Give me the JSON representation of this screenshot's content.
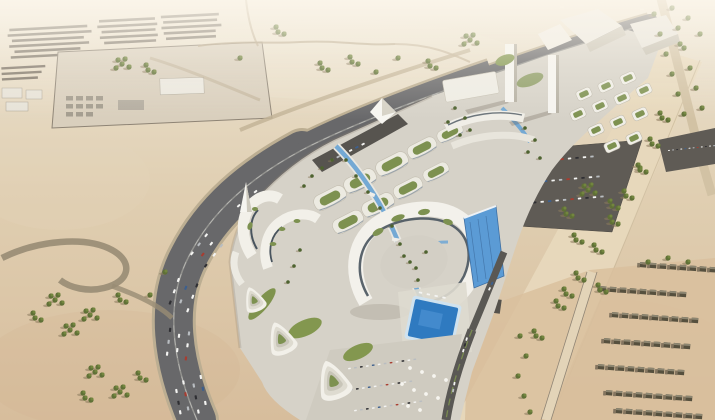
{
  "image": {
    "kind": "aerial-architectural-render",
    "no_visible_text": true,
    "description": "Bird's-eye 3D rendering of a modern desert mixed-use development: white curvilinear buildings with landscaped green roofs arranged on a diagonal podium, wrapped on the west by a curving multi-lane highway full of traffic. Features a sail-shaped spire, a large curved ribbon building with dark glazing and a blue glass slab, a rectangular blue pool with sun deck, stepped triangular terrace buildings, twin white towers with angular event halls and a grid of green-roofed pavilions, asphalt parking lots to the east, barracks-like row compounds to the north-west, scattered desert tree clusters, and a grid village of small flat-roofed houses in the south-east corner."
  },
  "scene": {
    "areas": [
      {
        "name": "northwest-compounds",
        "description": "Rows of dark low-rise barracks blocks and a walled service compound with trees"
      },
      {
        "name": "desert-plain",
        "description": "Open pale sand with faint graded tracks and scattered trees, hazy toward the horizon"
      },
      {
        "name": "west-highway",
        "description": "Curving multi-lane asphalt highway with dense car traffic wrapping the development"
      },
      {
        "name": "uturn-loop",
        "description": "U-turn ramp loop in the south-west desert"
      },
      {
        "name": "central-development",
        "description": "White organic-shaped buildings, palm-lined streets and a blue water canal"
      },
      {
        "name": "gateway-spire",
        "description": "White sail-shaped monument at the south-west gateway"
      },
      {
        "name": "ribbon-building",
        "description": "Large curved building with dark glass band, roof gardens and blue glass slab"
      },
      {
        "name": "pool-deck",
        "description": "Rectangular blue swimming pool with loungers, parasols and parking"
      },
      {
        "name": "terraced-triangles",
        "description": "Stepped triangular terrace buildings with green courtyards"
      },
      {
        "name": "northeast-cluster",
        "description": "Twin white towers, angular halls and grid of green-roofed pavilions"
      },
      {
        "name": "east-parking",
        "description": "Asphalt parking lots filled with cars along the eastern boulevard"
      },
      {
        "name": "southeast-village",
        "description": "Grid rows of small flat-roofed houses along a sand road"
      }
    ]
  },
  "palette": {
    "sand_light": "#ece4d3",
    "sand": "#dccaa9",
    "sand_deep": "#d7bd9c",
    "asphalt": "#68686a",
    "asphalt_dark": "#55534f",
    "concrete": "#d6d2c8",
    "building_white": "#f3f1eb",
    "building_shade": "#c7c2b4",
    "glass_dark": "#49545e",
    "glass_blue": "#5b9bd5",
    "water": "#2f7ac0",
    "canal": "#74a9d4",
    "tree_green": "#5f7036",
    "roof_green": "#7d9150",
    "village_roof": "#56503e"
  }
}
